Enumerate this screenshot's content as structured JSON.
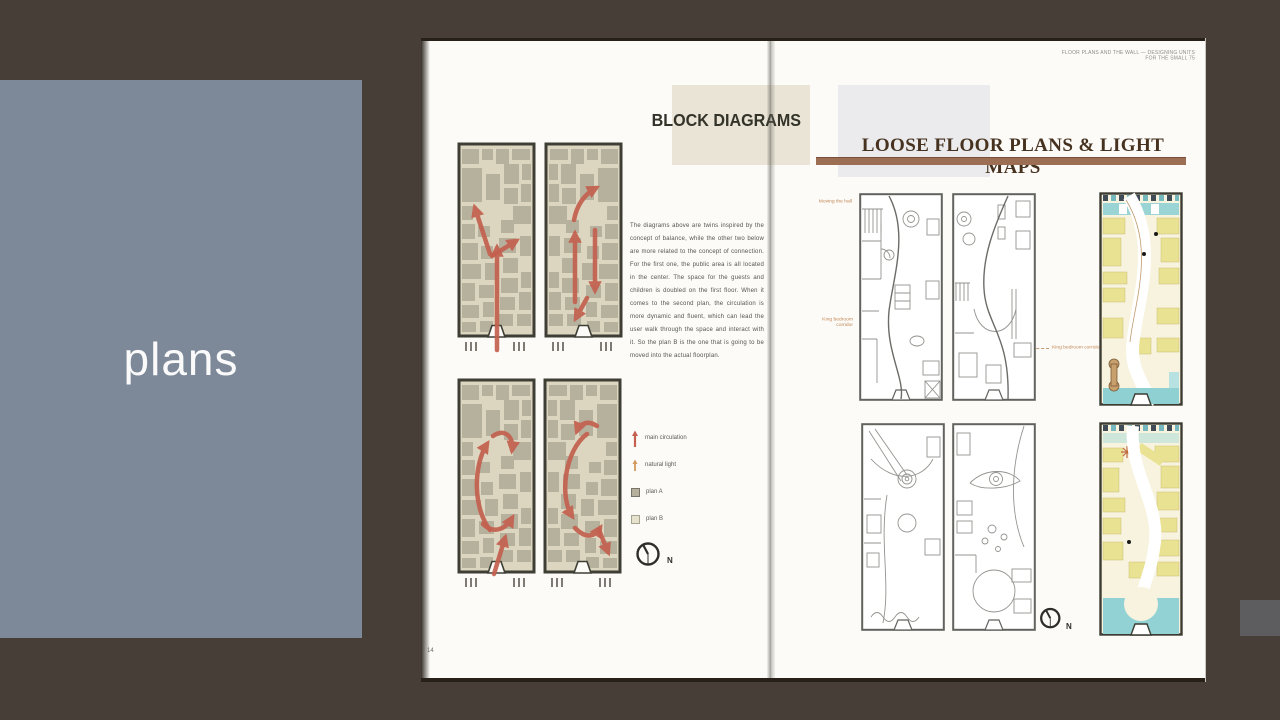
{
  "slide": {
    "background_color": "#473e37",
    "side_panel": {
      "label": "plans",
      "bg_color": "#7d8899",
      "text_color": "#fafafa"
    },
    "fragment_color": "#5d5d5f"
  },
  "book": {
    "left_page": {
      "header": "BLOCK DIAGRAMS",
      "body_text": "The diagrams above are twins inspired by the concept of balance, while the other two below are more related to the concept of connection. For the first one, the public area is all located in the center. The space for the guests and children is doubled on the first floor. When it comes to the second plan, the circulation is more dynamic and fluent, which can lead the user walk through the space and interact with it. So the plan B is the one that is going to be moved into the actual floorplan.",
      "legend": [
        {
          "icon": "red-arrow-icon",
          "label": "main circulation"
        },
        {
          "icon": "orange-arrow-icon",
          "label": "natural light"
        },
        {
          "icon": "dark-swatch-icon",
          "label": "plan A"
        },
        {
          "icon": "light-swatch-icon",
          "label": "plan B"
        }
      ],
      "compass_label": "N",
      "page_number": "14"
    },
    "right_page": {
      "running_header": "FLOOR PLANS AND THE WALL — DESIGNING UNITS FOR THE SMALL 75",
      "header": "LOOSE FLOOR PLANS & LIGHT MAPS",
      "annotations": {
        "a1": "Moving the hall",
        "a2": "King bedroom corridor",
        "a3": "King bedroom corridor"
      },
      "compass_label": "N"
    },
    "colors": {
      "accent_bar": "#9c6e54",
      "arrow": "#c4604f",
      "plan_fill": "#dcd6c1",
      "room_fill": "#b5b19d",
      "yellow_room": "#eae293",
      "teal": "#8fd0d2",
      "header_box": "#e9e4d6"
    }
  }
}
